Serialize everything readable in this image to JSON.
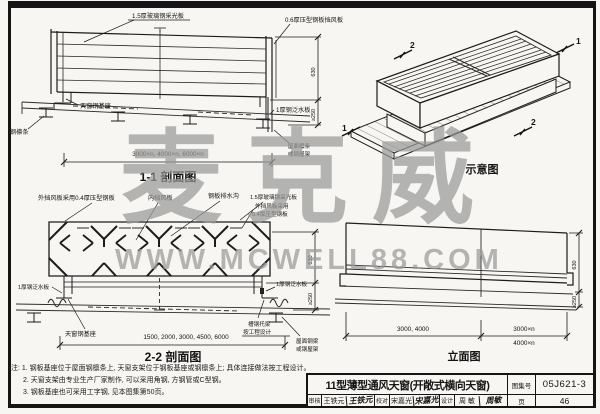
{
  "watermark": {
    "brand": "麦克威",
    "url": "WWW.MCWELL88.COM",
    "color": "#9a9a9a"
  },
  "s11": {
    "title": "1-1 剖面图",
    "label_panel": "1.5厚玻璃钢采光板",
    "label_windboard": "0.6厚压型钢板挡风板",
    "label_base": "天窗钢基座",
    "label_purlin": "钢檩条",
    "label_flashing": "1厚钢泛水板",
    "label_roof1": "屋面檩条",
    "label_roof2": "或钢屋架",
    "dim_span": "3000×n, 4000×n, 6000×n",
    "dim_height": "630",
    "dim_curb": "≥250"
  },
  "iso": {
    "title": "示意图",
    "mark_tl": "2",
    "mark_tr": "1",
    "mark_bl": "1",
    "mark_br": "2"
  },
  "s22": {
    "title": "2-2 剖面图",
    "label_outer": "外挡风板采用0.4厚压型钢板",
    "label_inner": "内挡风板",
    "label_gutter": "钢板排水沟",
    "label_panel": "1.5厚玻璃钢采光板",
    "label_outer_r1": "外挡风板采用",
    "label_outer_r2": "0.4厚压型钢板",
    "label_flashing_l": "1厚钢泛水板",
    "label_flashing_r": "1厚钢泛水板",
    "label_base": "天窗钢基座",
    "label_joist1": "槽钢托梁",
    "label_joist2": "按工程设计",
    "label_roof1": "屋面钢梁",
    "label_roof2": "或钢屋架",
    "dim_span": "1500, 2000, 3000, 4500, 6000",
    "dim_height": "630",
    "dim_curb": "≥250"
  },
  "elev": {
    "title": "立面图",
    "dim_left": "3000, 4000",
    "dim_right1": "3000×n",
    "dim_right2": "4000×n",
    "dim_height": "630",
    "dim_curb": "≥250"
  },
  "notes": {
    "items": [
      "注: 1. 钢板基座位于屋面钢檩条上, 天窗支架位于钢板基座或钢檩条上; 具体连接做法按工程设计。",
      "2. 天窗支架由专业生产厂家制作, 可以采用角钢, 方钢管或C型钢。",
      "3. 钢板基座也可采用工字钢, 见本图集第50页。"
    ]
  },
  "titleblock": {
    "title": "11型薄型通风天窗(开敞式横向天窗)",
    "atlas_label": "图集号",
    "atlas_no": "05J621-3",
    "page_label": "页",
    "page_no": "46",
    "review_label": "审核",
    "review_name": "王铁元",
    "review_sig": "王铁元",
    "check_label": "校对",
    "check_name": "宋嘉光",
    "check_sig": "宋嘉光",
    "design_label": "设计",
    "design_name": "周 敏",
    "design_sig": "周敏"
  }
}
